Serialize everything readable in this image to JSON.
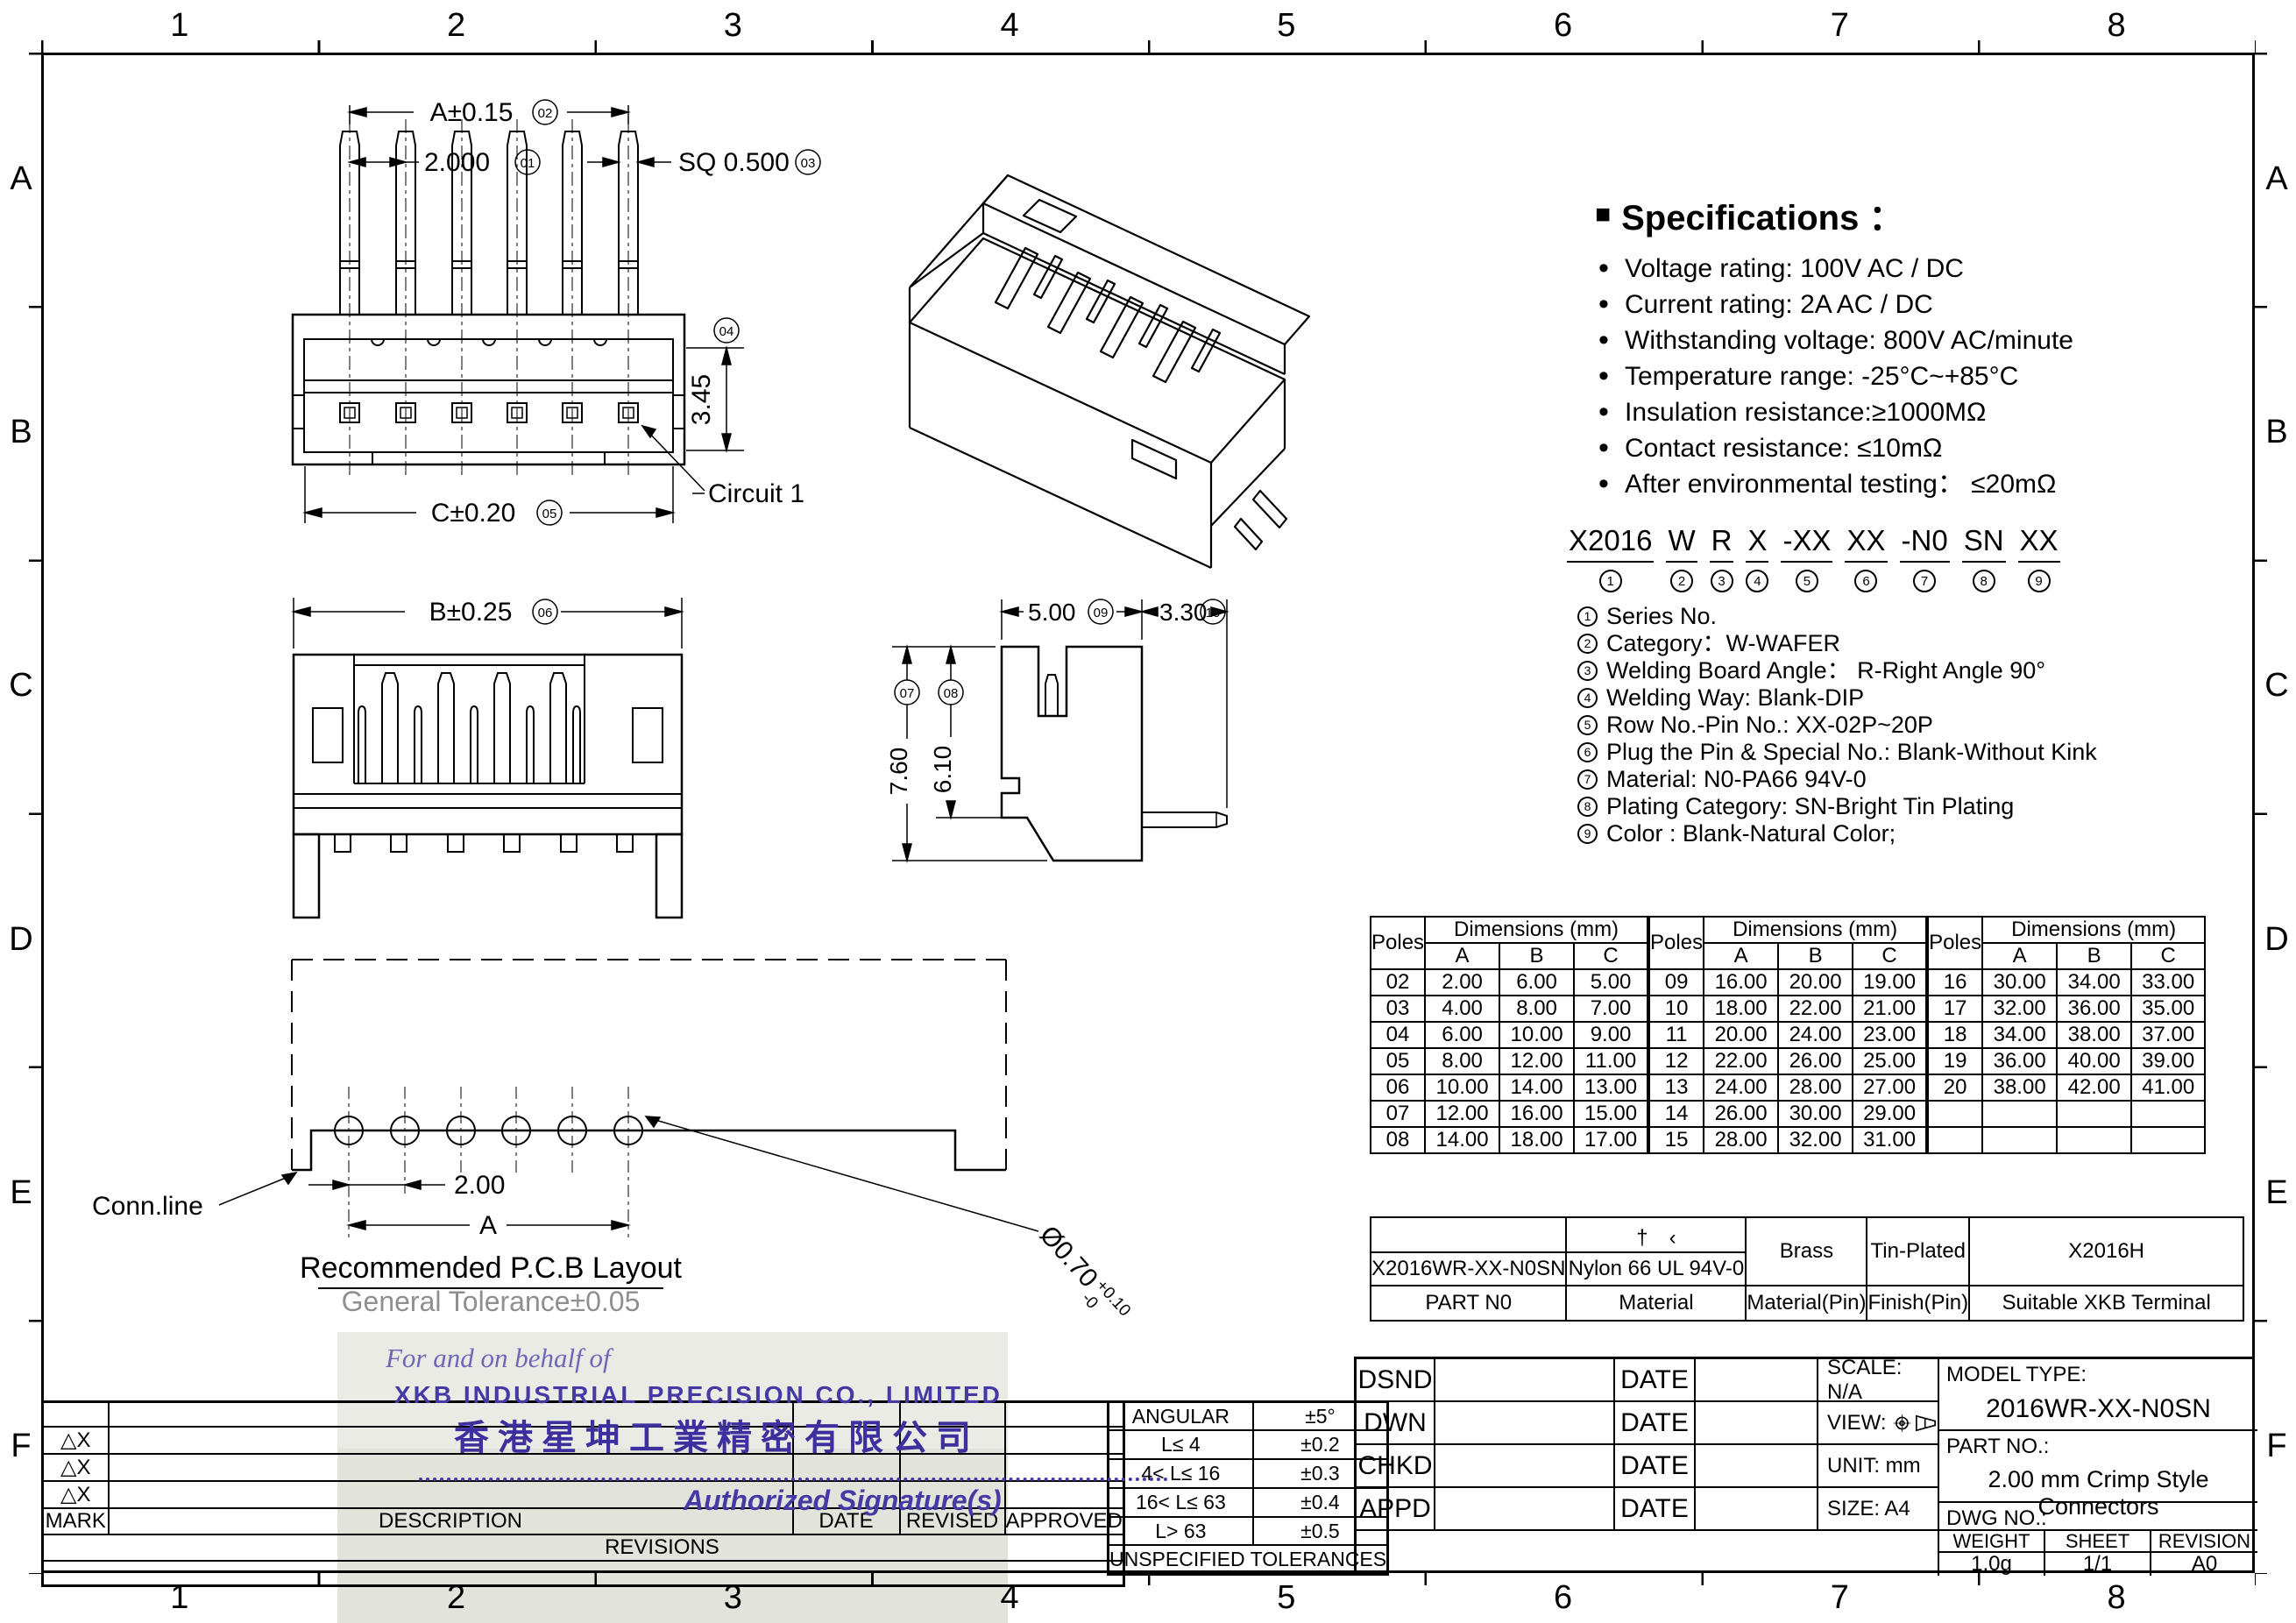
{
  "border": {
    "cols": [
      "1",
      "2",
      "3",
      "4",
      "5",
      "6",
      "7",
      "8"
    ],
    "rows": [
      "A",
      "B",
      "C",
      "D",
      "E",
      "F"
    ]
  },
  "specs": {
    "title": "Specifications ：",
    "items": [
      "Voltage rating: 100V AC / DC",
      "Current rating: 2A  AC / DC",
      "Withstanding voltage: 800V AC/minute",
      "Temperature range: -25°C~+85°C",
      "Insulation resistance:≥1000MΩ",
      "Contact resistance: ≤10mΩ",
      "After environmental testing：  ≤20mΩ"
    ]
  },
  "part_code": {
    "segments": [
      {
        "t": "X2016",
        "n": "1"
      },
      {
        "t": "W",
        "n": "2"
      },
      {
        "t": "R",
        "n": "3"
      },
      {
        "t": "X",
        "n": "4"
      },
      {
        "t": "-XX",
        "n": "5"
      },
      {
        "t": "XX",
        "n": "6"
      },
      {
        "t": "-N0",
        "n": "7"
      },
      {
        "t": "SN",
        "n": "8"
      },
      {
        "t": "XX",
        "n": "9"
      }
    ],
    "legend": [
      {
        "n": "1",
        "t": "Series No."
      },
      {
        "n": "2",
        "t": "Category：W-WAFER"
      },
      {
        "n": "3",
        "t": "Welding Board Angle：  R-Right Angle 90°"
      },
      {
        "n": "4",
        "t": "Welding Way:  Blank-DIP"
      },
      {
        "n": "5",
        "t": "Row No.-Pin No.:  XX-02P~20P"
      },
      {
        "n": "6",
        "t": "Plug the Pin & Special No.: Blank-Without Kink"
      },
      {
        "n": "7",
        "t": "Material:  N0-PA66 94V-0"
      },
      {
        "n": "8",
        "t": "Plating Category:  SN-Bright Tin Plating"
      },
      {
        "n": "9",
        "t": "Color :  Blank-Natural Color;"
      }
    ]
  },
  "views": {
    "top": {
      "dim_pitch": "2.000",
      "n_pitch": "01",
      "dim_a": "A±0.15",
      "n_a": "02",
      "dim_sq": "SQ 0.500",
      "n_sq": "03",
      "dim_h": "3.45",
      "n_h": "04",
      "dim_c": "C±0.20",
      "n_c": "05",
      "circuit": "Circuit 1"
    },
    "front": {
      "dim_b": "B±0.25",
      "n_b": "06"
    },
    "side": {
      "dim_w": "5.00",
      "n_w": "09",
      "dim_tail": "3.30",
      "n_tail": "10",
      "dim_h": "7.60",
      "n_h": "07",
      "dim_h2": "6.10",
      "n_h2": "08"
    },
    "pcb": {
      "dim_pitch": "2.00",
      "dim_span": "A",
      "conn": "Conn.line",
      "hole": "Ø0.70",
      "hole_up": "+0.10",
      "hole_dn": "-0",
      "title": "Recommended P.C.B Layout",
      "tolerance": "General Tolerance±0.05"
    }
  },
  "dim_table": {
    "poles": "Poles",
    "dims": "Dimensions (mm)",
    "a": "A",
    "b": "B",
    "c": "C",
    "g1": [
      [
        "02",
        "2.00",
        "6.00",
        "5.00"
      ],
      [
        "03",
        "4.00",
        "8.00",
        "7.00"
      ],
      [
        "04",
        "6.00",
        "10.00",
        "9.00"
      ],
      [
        "05",
        "8.00",
        "12.00",
        "11.00"
      ],
      [
        "06",
        "10.00",
        "14.00",
        "13.00"
      ],
      [
        "07",
        "12.00",
        "16.00",
        "15.00"
      ],
      [
        "08",
        "14.00",
        "18.00",
        "17.00"
      ]
    ],
    "g2": [
      [
        "09",
        "16.00",
        "20.00",
        "19.00"
      ],
      [
        "10",
        "18.00",
        "22.00",
        "21.00"
      ],
      [
        "11",
        "20.00",
        "24.00",
        "23.00"
      ],
      [
        "12",
        "22.00",
        "26.00",
        "25.00"
      ],
      [
        "13",
        "24.00",
        "28.00",
        "27.00"
      ],
      [
        "14",
        "26.00",
        "30.00",
        "29.00"
      ],
      [
        "15",
        "28.00",
        "32.00",
        "31.00"
      ]
    ],
    "g3": [
      [
        "16",
        "30.00",
        "34.00",
        "33.00"
      ],
      [
        "17",
        "32.00",
        "36.00",
        "35.00"
      ],
      [
        "18",
        "34.00",
        "38.00",
        "37.00"
      ],
      [
        "19",
        "36.00",
        "40.00",
        "39.00"
      ],
      [
        "20",
        "38.00",
        "42.00",
        "41.00"
      ],
      [
        "",
        "",
        "",
        ""
      ],
      [
        "",
        "",
        "",
        ""
      ]
    ]
  },
  "material_table": {
    "top_note": "†　‹",
    "part_no": "X2016WR-XX-N0SN",
    "material": "Nylon 66  UL 94V-0",
    "pin_material": "Brass",
    "pin_finish": "Tin-Plated",
    "terminal": "X2016H",
    "l_part": "PART N0",
    "l_material": "Material",
    "l_pin_material": "Material(Pin)",
    "l_pin_finish": "Finish(Pin)",
    "l_terminal": "Suitable XKB Terminal"
  },
  "tolerances": {
    "rows": [
      [
        "ANGULAR",
        "±5°"
      ],
      [
        "L≤ 4",
        "±0.2"
      ],
      [
        "4< L≤ 16",
        "±0.3"
      ],
      [
        "16< L≤ 63",
        "±0.4"
      ],
      [
        "L> 63",
        "±0.5"
      ]
    ],
    "footer": "UNSPECIFIED  TOLERANCES"
  },
  "revisions": {
    "marks": [
      "",
      "△X",
      "△X",
      "△X"
    ],
    "h_mark": "MARK",
    "h_desc": "DESCRIPTION",
    "h_date": "DATE",
    "h_revised": "REVISED",
    "h_approved": "APPROVED",
    "footer": "REVISIONS"
  },
  "title_block": {
    "rows": [
      {
        "label": "DSND",
        "date": "DATE"
      },
      {
        "label": "DWN",
        "date": "DATE"
      },
      {
        "label": "CHKD",
        "date": "DATE"
      },
      {
        "label": "APPD",
        "date": "DATE"
      }
    ],
    "scale": "SCALE: N/A",
    "view": "VIEW:",
    "unit": "UNIT:  mm",
    "size": "SIZE:  A4",
    "model_label": "MODEL TYPE:",
    "model": "2016WR-XX-N0SN",
    "part_label": "PART NO.:",
    "part": "2.00 mm Crimp Style Connectors",
    "dwg_label": "DWG NO.:",
    "weight_label": "WEIGHT",
    "sheet_label": "SHEET",
    "revision_label": "REVISION",
    "weight": "1.0g",
    "sheet": "1/1",
    "revision": "A0"
  },
  "stamp": {
    "line1": "For and on behalf of",
    "company_en": "XKB INDUSTRIAL PRECISION CO., LIMITED",
    "company_cn": "香港星坤工業精密有限公司",
    "sign": "Authorized Signature(s)"
  }
}
